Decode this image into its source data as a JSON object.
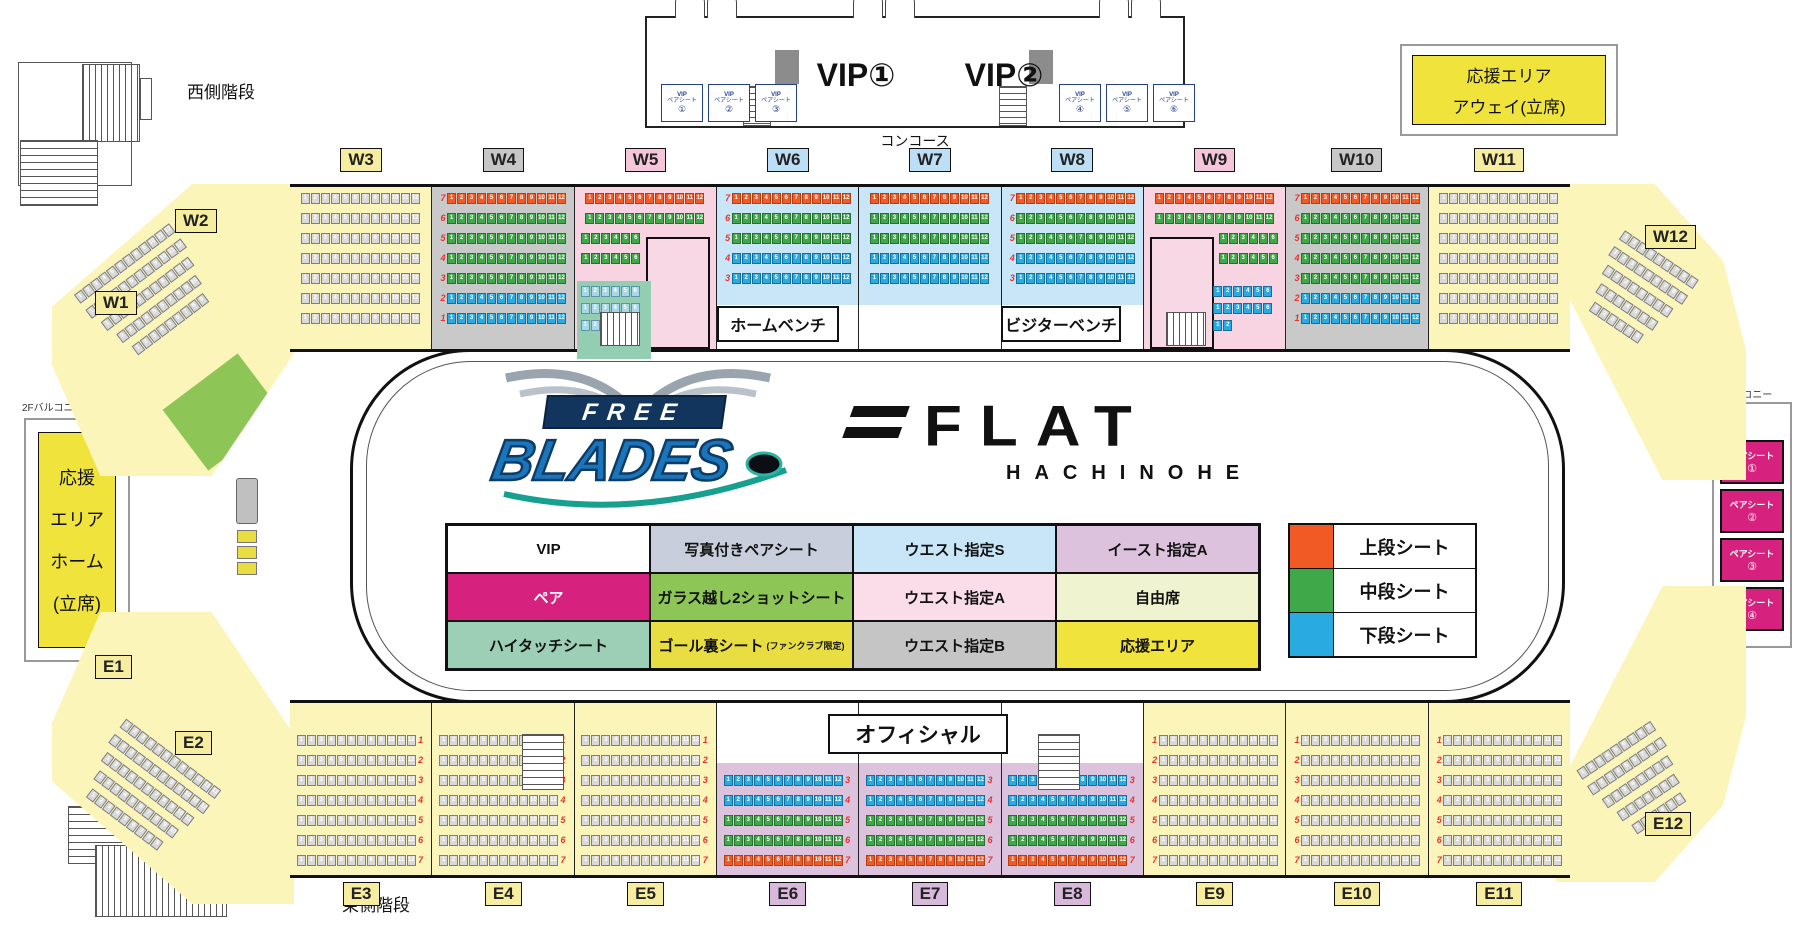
{
  "colors": {
    "tier_upper": "#F15A24",
    "tier_upper_border": "#B53E12",
    "tier_middle": "#3FA848",
    "tier_middle_border": "#277031",
    "tier_lower": "#29ABE2",
    "tier_lower_border": "#146F9E",
    "seat_gray": "#D9D9D9",
    "seat_gray_border": "#7F7F7F",
    "seat_pale": "#A9D6E8",
    "seat_pale_border": "#5E93AC",
    "bg_yellow": "#FBF5B9",
    "bg_gray": "#C9C9C9",
    "bg_pink": "#F8D3E2",
    "bg_blue": "#C9E6F8",
    "bg_purple": "#DCC2DD",
    "teal_patch": "#93CDB2",
    "magenta": "#D6217E",
    "accent_yellow": "#EFE33C",
    "row_number_red": "#E8322E"
  },
  "row_kinds": {
    "full7": [
      {
        "n": 7,
        "t": "u",
        "c": 12
      },
      {
        "n": 6,
        "t": "m",
        "c": 12
      },
      {
        "n": 5,
        "t": "m",
        "c": 12
      },
      {
        "n": 4,
        "t": "m",
        "c": 12
      },
      {
        "n": 3,
        "t": "m",
        "c": 12
      },
      {
        "n": 2,
        "t": "l",
        "c": 12
      },
      {
        "n": 1,
        "t": "l",
        "c": 12
      }
    ],
    "short5": [
      {
        "n": 7,
        "t": "u",
        "c": 12
      },
      {
        "n": 6,
        "t": "m",
        "c": 12
      },
      {
        "n": 5,
        "t": "m",
        "c": 12
      },
      {
        "n": 4,
        "t": "l",
        "c": 12
      },
      {
        "n": 3,
        "t": "l",
        "c": 12
      }
    ],
    "gray_top": [
      {
        "n": 7,
        "t": "g",
        "c": 12
      },
      {
        "n": 6,
        "t": "g",
        "c": 12
      },
      {
        "n": 5,
        "t": "g",
        "c": 12
      },
      {
        "n": 4,
        "t": "g",
        "c": 12
      },
      {
        "n": 3,
        "t": "g",
        "c": 12
      },
      {
        "n": 2,
        "t": "g",
        "c": 12
      },
      {
        "n": 1,
        "t": "g",
        "c": 12
      }
    ],
    "gray_bottom": [
      {
        "n": 1,
        "t": "g",
        "c": 12
      },
      {
        "n": 2,
        "t": "g",
        "c": 12
      },
      {
        "n": 3,
        "t": "g",
        "c": 12
      },
      {
        "n": 4,
        "t": "g",
        "c": 12
      },
      {
        "n": 5,
        "t": "g",
        "c": 12
      },
      {
        "n": 6,
        "t": "g",
        "c": 12
      },
      {
        "n": 7,
        "t": "g",
        "c": 12
      }
    ],
    "purple5": [
      {
        "n": 3,
        "t": "l",
        "c": 12
      },
      {
        "n": 4,
        "t": "l",
        "c": 12
      },
      {
        "n": 5,
        "t": "m",
        "c": 12
      },
      {
        "n": 6,
        "t": "m",
        "c": 12
      },
      {
        "n": 7,
        "t": "u",
        "c": 12
      }
    ],
    "pink_left": [
      {
        "n": 7,
        "t": "u",
        "c": 12
      },
      {
        "n": 6,
        "t": "m",
        "c": 12
      },
      {
        "n": 5,
        "t": "m",
        "c": 6,
        "align": "left"
      },
      {
        "n": 4,
        "t": "m",
        "c": 6,
        "align": "left"
      }
    ],
    "pink_right": [
      {
        "n": 7,
        "t": "u",
        "c": 12
      },
      {
        "n": 6,
        "t": "m",
        "c": 12
      },
      {
        "n": 5,
        "t": "m",
        "c": 6,
        "align": "right"
      },
      {
        "n": 4,
        "t": "m",
        "c": 6,
        "align": "right"
      }
    ],
    "pale3": [
      {
        "t": "p",
        "c": 6
      },
      {
        "t": "p",
        "c": 6
      },
      {
        "t": "p",
        "c": 2
      }
    ],
    "blue3": [
      {
        "t": "l",
        "c": 6
      },
      {
        "t": "l",
        "c": 6
      },
      {
        "t": "l",
        "c": 2
      }
    ],
    "corner": [
      {
        "t": "g",
        "c": 12
      },
      {
        "t": "g",
        "c": 12
      },
      {
        "t": "g",
        "c": 11
      },
      {
        "t": "g",
        "c": 10
      },
      {
        "t": "g",
        "c": 9
      }
    ],
    "corner_r": [
      {
        "t": "g",
        "c": 9
      },
      {
        "t": "g",
        "c": 9
      },
      {
        "t": "g",
        "c": 8
      },
      {
        "t": "g",
        "c": 7
      },
      {
        "t": "g",
        "c": 6
      }
    ]
  },
  "top_sections": [
    {
      "id": "W3",
      "bg": "yellow",
      "kind": "gray_top",
      "numSide": null,
      "chip": "yellow"
    },
    {
      "id": "W4",
      "bg": "gray",
      "kind": "full7",
      "numSide": "left",
      "chip": "gray"
    },
    {
      "id": "W5",
      "bg": "pink",
      "kind": "pink_left",
      "numSide": null,
      "chip": "pink",
      "special": "w5"
    },
    {
      "id": "W6",
      "bg": "blue",
      "kind": "short5",
      "numSide": "left",
      "chip": "blue"
    },
    {
      "id": "W7",
      "bg": "blue",
      "kind": "short5",
      "numSide": null,
      "chip": "blue"
    },
    {
      "id": "W8",
      "bg": "blue",
      "kind": "short5",
      "numSide": "left",
      "chip": "blue"
    },
    {
      "id": "W9",
      "bg": "pink",
      "kind": "pink_right",
      "numSide": null,
      "chip": "pink",
      "special": "w9"
    },
    {
      "id": "W10",
      "bg": "gray",
      "kind": "full7",
      "numSide": "left",
      "chip": "gray"
    },
    {
      "id": "W11",
      "bg": "yellow",
      "kind": "gray_top",
      "numSide": null,
      "chip": "yellow"
    }
  ],
  "bottom_sections": [
    {
      "id": "E3",
      "bg": "yellow",
      "kind": "gray_bottom",
      "numSide": "right",
      "chip": "yellow"
    },
    {
      "id": "E4",
      "bg": "yellow",
      "kind": "gray_bottom",
      "numSide": "right",
      "chip": "yellow"
    },
    {
      "id": "E5",
      "bg": "yellow",
      "kind": "gray_bottom",
      "numSide": "right",
      "chip": "yellow"
    },
    {
      "id": "E6",
      "bg": "purple",
      "kind": "purple5",
      "numSide": "right",
      "chip": "purple"
    },
    {
      "id": "E7",
      "bg": "purple",
      "kind": "purple5",
      "numSide": "right",
      "chip": "purple"
    },
    {
      "id": "E8",
      "bg": "purple",
      "kind": "purple5",
      "numSide": "right",
      "chip": "purple"
    },
    {
      "id": "E9",
      "bg": "yellow",
      "kind": "gray_bottom",
      "numSide": "left",
      "chip": "yellow"
    },
    {
      "id": "E10",
      "bg": "yellow",
      "kind": "gray_bottom",
      "numSide": "left",
      "chip": "yellow"
    },
    {
      "id": "E11",
      "bg": "yellow",
      "kind": "gray_bottom",
      "numSide": "left",
      "chip": "yellow"
    }
  ],
  "corner_chips": [
    {
      "id": "W1",
      "pos": "w1",
      "chip": "yellow"
    },
    {
      "id": "W2",
      "pos": "w2",
      "chip": "yellow"
    },
    {
      "id": "W12",
      "pos": "w12",
      "chip": "yellow"
    },
    {
      "id": "E1",
      "pos": "e1",
      "chip": "yellow"
    },
    {
      "id": "E2",
      "pos": "e2",
      "chip": "yellow"
    },
    {
      "id": "E12",
      "pos": "e12",
      "chip": "yellow"
    }
  ],
  "legend_table": [
    [
      {
        "label": "VIP",
        "bg": "#FFFFFF",
        "fg": "#111111"
      },
      {
        "label": "写真付きペアシート",
        "bg": "#C9CEDC",
        "fg": "#111111"
      },
      {
        "label": "ウエスト指定S",
        "bg": "#C9E6F8",
        "fg": "#111111"
      },
      {
        "label": "イースト指定A",
        "bg": "#DCC2DD",
        "fg": "#111111"
      }
    ],
    [
      {
        "label": "ペア",
        "bg": "#D6217E",
        "fg": "#FFFFFF"
      },
      {
        "label": "ガラス越し2ショットシート",
        "bg": "#8DC556",
        "fg": "#111111"
      },
      {
        "label": "ウエスト指定A",
        "bg": "#FADDE9",
        "fg": "#111111"
      },
      {
        "label": "自由席",
        "bg": "#EFF3CF",
        "fg": "#111111"
      }
    ],
    [
      {
        "label": "ハイタッチシート",
        "bg": "#9CCFB6",
        "fg": "#111111"
      },
      {
        "label": "ゴール裏シート",
        "sub": "(ファンクラブ限定)",
        "bg": "#E8DD41",
        "fg": "#111111"
      },
      {
        "label": "ウエスト指定B",
        "bg": "#C5C5C5",
        "fg": "#111111"
      },
      {
        "label": "応援エリア",
        "bg": "#EFE33C",
        "fg": "#111111"
      }
    ]
  ],
  "legend_tiers": [
    {
      "label": "上段シート",
      "color": "#F15A24"
    },
    {
      "label": "中段シート",
      "color": "#3FA848"
    },
    {
      "label": "下段シート",
      "color": "#29ABE2"
    }
  ],
  "concourse": {
    "label": "コンコース",
    "vip_room1": "VIP①",
    "vip_room2": "VIP②",
    "pair_line1": "VIP",
    "pair_line2": "ペアシート",
    "pair_left": [
      "①",
      "②",
      "③"
    ],
    "pair_right": [
      "④",
      "⑤",
      "⑥"
    ]
  },
  "stairs": {
    "west": "西側階段",
    "east": "東側階段"
  },
  "standing": {
    "away_line1": "応援エリア",
    "away_line2": "アウェイ(立席)",
    "home_lines": [
      "応援",
      "エリア",
      "ホーム",
      "(立席)"
    ],
    "balcony_left": "2Fバルコニー",
    "balcony_right": "2F バルコニー"
  },
  "pair_seats_right": {
    "label": "ペアシート",
    "items": [
      "①",
      "②",
      "③",
      "④"
    ]
  },
  "benches": {
    "home": "ホームベンチ",
    "visitor": "ビジターベンチ",
    "official": "オフィシャル"
  },
  "logos": {
    "free": "FREE",
    "blades": "BLADES",
    "flat": "FLAT",
    "hachinohe": "HACHINOHE"
  }
}
